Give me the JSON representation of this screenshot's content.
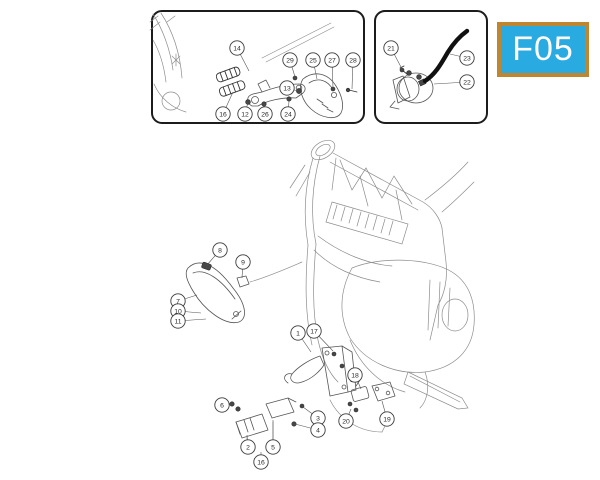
{
  "badge": {
    "label": "F05",
    "bg_color": "#29abe2",
    "border_color": "#c0862f",
    "text_color": "#ffffff"
  },
  "diagram": {
    "background": "#ffffff",
    "line_color": "#555555",
    "panel_border_color": "#1c1c1c",
    "callout_style": {
      "radius": 7.2,
      "circle_color": "#3c3c3c",
      "text_color": "#2b2b2b",
      "leader_color": "#555555",
      "font_size": 6.8
    },
    "groups": [
      {
        "name": "footrest-bracket-inset",
        "items": [
          {
            "n": "14",
            "x": 237,
            "y": 48,
            "tx": 249,
            "ty": 71
          },
          {
            "n": "29",
            "x": 290,
            "y": 60,
            "tx": 295,
            "ty": 77
          },
          {
            "n": "25",
            "x": 313,
            "y": 60,
            "tx": 317,
            "ty": 79
          },
          {
            "n": "27",
            "x": 332,
            "y": 60,
            "tx": 333,
            "ty": 88
          },
          {
            "n": "28",
            "x": 353,
            "y": 60,
            "tx": 352,
            "ty": 89
          },
          {
            "n": "13",
            "x": 287,
            "y": 88,
            "tx": 298,
            "ty": 91
          },
          {
            "n": "16",
            "x": 223,
            "y": 114,
            "tx": 233,
            "ty": 92
          },
          {
            "n": "12",
            "x": 245,
            "y": 114,
            "tx": 248,
            "ty": 102
          },
          {
            "n": "26",
            "x": 265,
            "y": 114,
            "tx": 264,
            "ty": 104
          },
          {
            "n": "24",
            "x": 288,
            "y": 114,
            "tx": 289,
            "ty": 101
          }
        ]
      },
      {
        "name": "solenoid-inset",
        "items": [
          {
            "n": "21",
            "x": 391,
            "y": 48,
            "tx": 402,
            "ty": 69
          },
          {
            "n": "23",
            "x": 467,
            "y": 58,
            "tx": 450,
            "ty": 54
          },
          {
            "n": "22",
            "x": 467,
            "y": 82,
            "tx": 434,
            "ty": 84
          }
        ]
      },
      {
        "name": "main-assembly",
        "items": [
          {
            "n": "8",
            "x": 220,
            "y": 250,
            "tx": 207,
            "ty": 265
          },
          {
            "n": "9",
            "x": 243,
            "y": 262,
            "tx": 242,
            "ty": 278
          },
          {
            "n": "7",
            "x": 178,
            "y": 301,
            "tx": 197,
            "ty": 295
          },
          {
            "n": "10",
            "x": 178,
            "y": 311,
            "tx": 201,
            "ty": 313
          },
          {
            "n": "11",
            "x": 178,
            "y": 321,
            "tx": 206,
            "ty": 319
          },
          {
            "n": "1",
            "x": 298,
            "y": 333,
            "tx": 311,
            "ty": 352
          },
          {
            "n": "17",
            "x": 314,
            "y": 331,
            "tx": 333,
            "ty": 351
          },
          {
            "n": "18",
            "x": 355,
            "y": 375,
            "tx": 361,
            "ty": 389
          },
          {
            "n": "6",
            "x": 222,
            "y": 405,
            "tx": 231,
            "ty": 404
          },
          {
            "n": "2",
            "x": 248,
            "y": 447,
            "tx": 247,
            "ty": 435
          },
          {
            "n": "5",
            "x": 273,
            "y": 447,
            "tx": 273,
            "ty": 420
          },
          {
            "n": "16",
            "x": 261,
            "y": 462,
            "tx": 261,
            "ty": 452
          },
          {
            "n": "3",
            "x": 318,
            "y": 418,
            "tx": 303,
            "ty": 407
          },
          {
            "n": "4",
            "x": 318,
            "y": 430,
            "tx": 295,
            "ty": 424
          },
          {
            "n": "20",
            "x": 346,
            "y": 421,
            "tx": 351,
            "ty": 409
          },
          {
            "n": "19",
            "x": 387,
            "y": 419,
            "tx": 382,
            "ty": 401
          }
        ]
      }
    ]
  }
}
